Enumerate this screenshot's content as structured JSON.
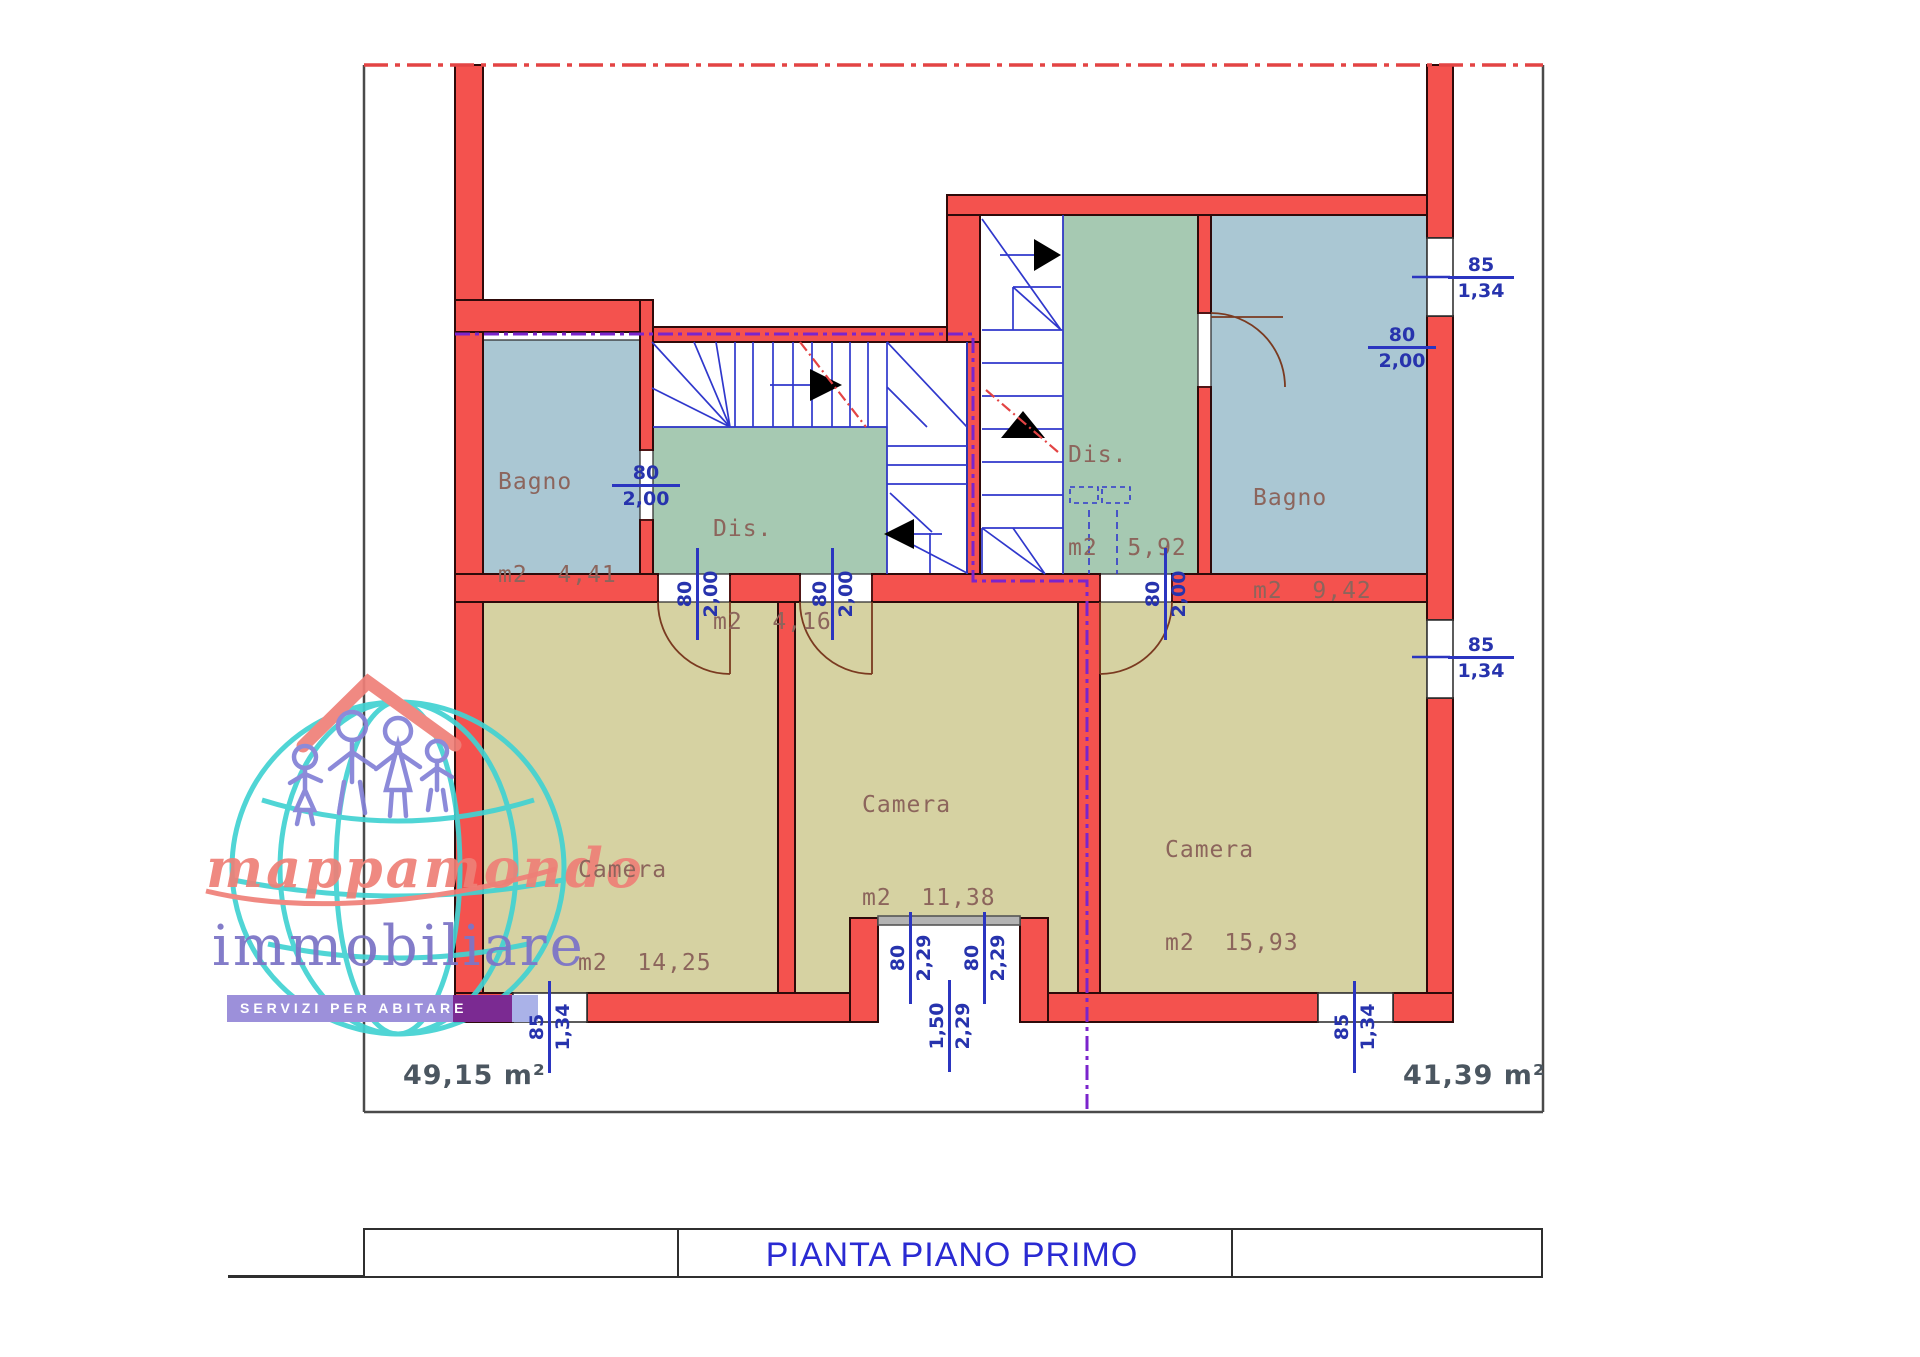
{
  "drawing": {
    "type": "floor-plan",
    "floor_title": "PIANTA PIANO PRIMO"
  },
  "plan": {
    "rooms": [
      {
        "id": "bagno-left",
        "name": "Bagno",
        "area": "m2  4,41"
      },
      {
        "id": "dis-left",
        "name": "Dis.",
        "area": "m2  4,16"
      },
      {
        "id": "dis-right",
        "name": "Dis.",
        "area": "m2  5,92"
      },
      {
        "id": "bagno-right",
        "name": "Bagno",
        "area": "m2  9,42"
      },
      {
        "id": "camera-left",
        "name": "Camera",
        "area": "m2  14,25"
      },
      {
        "id": "camera-mid",
        "name": "Camera",
        "area": "m2  11,38"
      },
      {
        "id": "camera-right",
        "name": "Camera",
        "area": "m2  15,93"
      }
    ],
    "dimensions": [
      {
        "id": "bagno-left-door",
        "top": "80",
        "bottom": "2,00"
      },
      {
        "id": "bagno-right-door",
        "top": "80",
        "bottom": "2,00"
      },
      {
        "id": "window-right-top",
        "top": "85",
        "bottom": "1,34"
      },
      {
        "id": "window-right-bottom",
        "top": "85",
        "bottom": "1,34"
      },
      {
        "id": "camera-left-door",
        "top": "80",
        "bottom": "2,00"
      },
      {
        "id": "camera-mid-door",
        "top": "80",
        "bottom": "2,00"
      },
      {
        "id": "camera-right-door",
        "top": "80",
        "bottom": "2,00"
      },
      {
        "id": "recess-left",
        "top": "80",
        "bottom": "2,29"
      },
      {
        "id": "recess-right",
        "top": "80",
        "bottom": "2,29"
      },
      {
        "id": "recess-center",
        "top": "1,50",
        "bottom": "2,29"
      },
      {
        "id": "window-bottom-left",
        "top": "85",
        "bottom": "1,34"
      },
      {
        "id": "window-bottom-right",
        "top": "85",
        "bottom": "1,34"
      }
    ],
    "unit_areas": {
      "left": "49,15 m²",
      "right": "41,39 m²"
    }
  },
  "logo": {
    "script": "mappamondo",
    "word": "immobiliare",
    "banner": "SERVIZI PER ABITARE"
  },
  "colors": {
    "wall_red": "#f4524e",
    "wall_outline": "#2e0a0a",
    "bagno_fill": "#aac7d3",
    "dis_fill": "#a6c9b2",
    "camera_fill": "#d6d2a2",
    "stair_blue": "#3038cc",
    "dim_blue": "#2733ad",
    "division_purple": "#7b24cc",
    "section_red_dash": "#e34444",
    "door_arc_brown": "#7a3a20",
    "title_blue": "#2a2ad2",
    "label_brown": "#8c655c",
    "area_text": "#4b5660",
    "logo_salmon": "#ee8077",
    "logo_purple": "#7d75c7",
    "logo_teal": "#42d2d2",
    "banner_lavender": "#9c90da",
    "banner_dark_purple": "#7b2a92"
  }
}
